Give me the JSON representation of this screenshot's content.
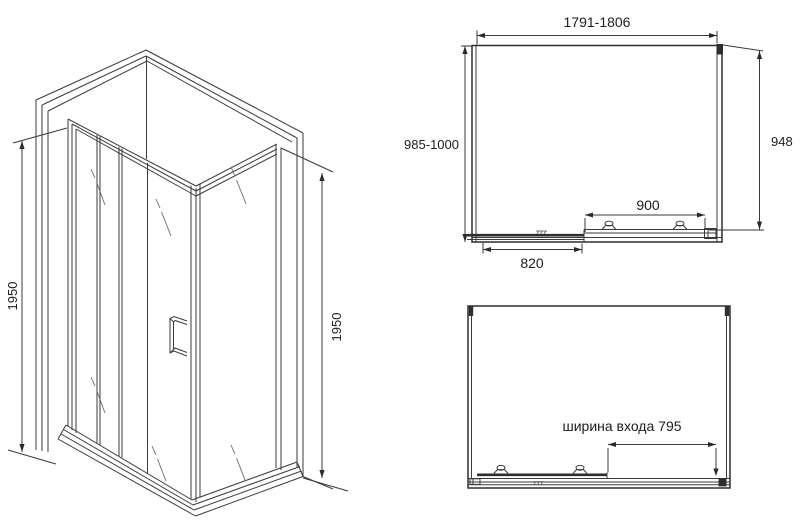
{
  "colors": {
    "background": "#ffffff",
    "line": "#3a3a3a",
    "text": "#1c1c1c"
  },
  "perspective_view": {
    "dim_height_left": "1950",
    "dim_height_right": "1950"
  },
  "front_view": {
    "dim_width_top": "1791-1806",
    "dim_depth_left": "985-1000",
    "dim_side_right": "948",
    "dim_door": "900",
    "dim_panel": "820"
  },
  "plan_view": {
    "dim_entrance": "ширина входа 795"
  }
}
